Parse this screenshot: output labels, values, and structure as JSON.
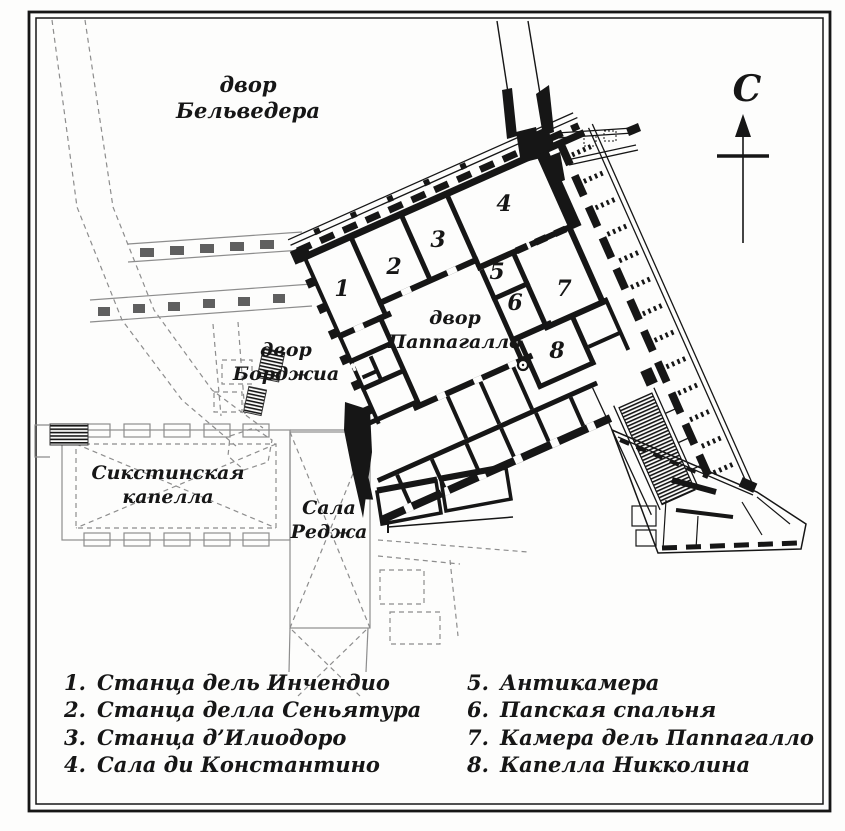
{
  "map": {
    "courtyards": {
      "belvedere": {
        "l1": "двор",
        "l2": "Бельведера"
      },
      "borgia": {
        "l1": "двор",
        "l2": "Борджиа"
      },
      "pappagallo": {
        "l1": "двор",
        "l2": "Паппагалло"
      }
    },
    "buildings": {
      "sistine": {
        "l1": "Сикстинская",
        "l2": "капелла"
      },
      "sala_regia": {
        "l1": "Сала",
        "l2": "Реджа"
      }
    },
    "compass_letter": "С",
    "room_numbers": {
      "n1": "1",
      "n2": "2",
      "n3": "3",
      "n4": "4",
      "n5": "5",
      "n6": "6",
      "n7": "7",
      "n8": "8"
    }
  },
  "legend": {
    "items": [
      {
        "num": "1.",
        "label": "Станца дель Инчендио"
      },
      {
        "num": "2.",
        "label": "Станца делла Сеньятура"
      },
      {
        "num": "3.",
        "label": "Станца д’Илиодоро"
      },
      {
        "num": "4.",
        "label": "Сала ди Константино"
      },
      {
        "num": "5.",
        "label": "Антикамера"
      },
      {
        "num": "6.",
        "label": "Папская спальня"
      },
      {
        "num": "7.",
        "label": "Камера дель Паппагалло"
      },
      {
        "num": "8.",
        "label": "Капелла Никколина"
      }
    ]
  },
  "colors": {
    "ink": "#161616",
    "light_lines": "#8d8d8d",
    "paper": "#fdfdfc"
  }
}
